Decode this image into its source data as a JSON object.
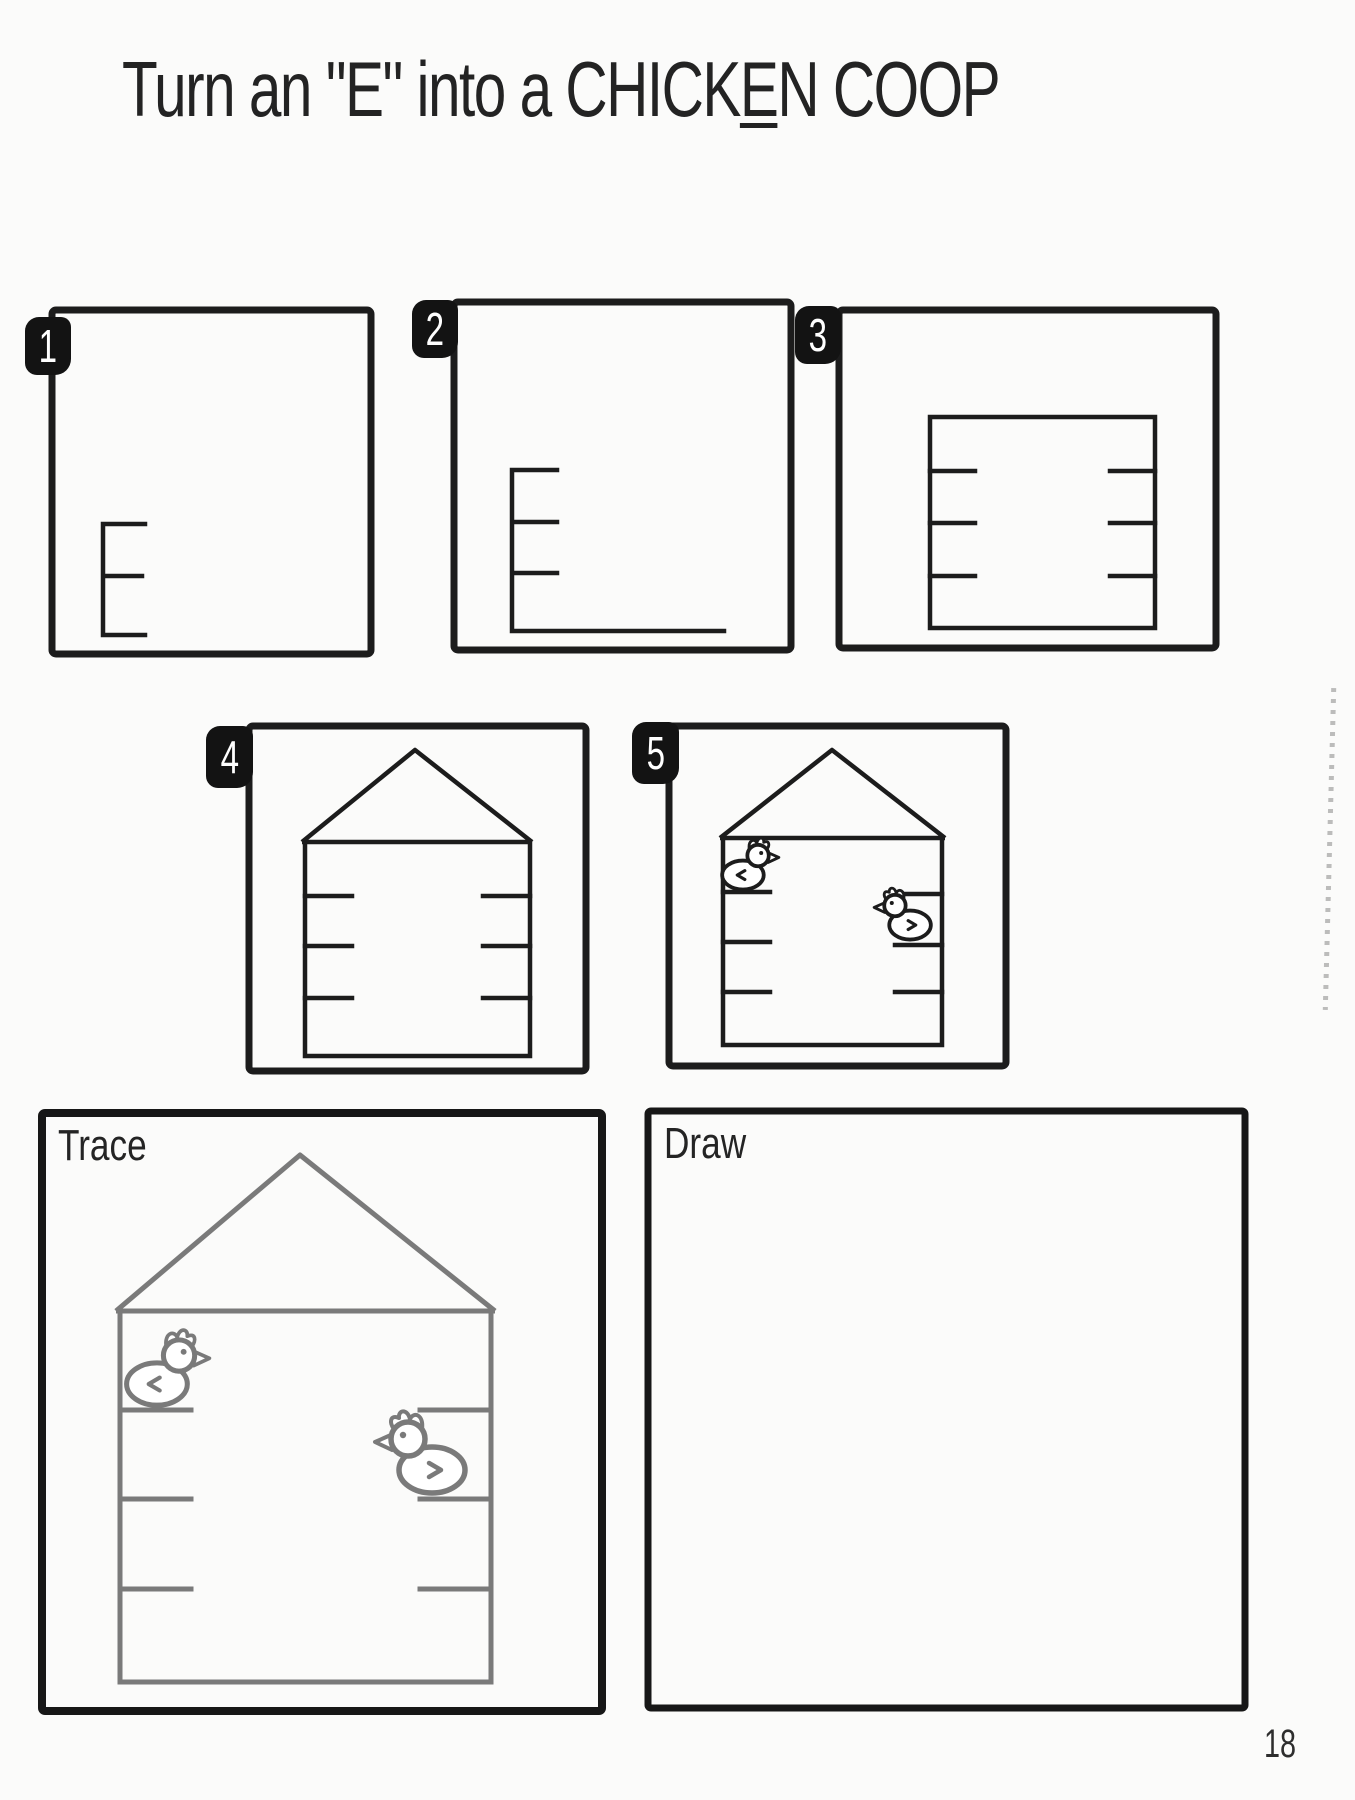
{
  "title": {
    "part1": "Turn an \"E\" into a CHICK",
    "underlined_letter": "E",
    "part3": "N COOP"
  },
  "steps": [
    {
      "number": "1",
      "figure": "letter-E"
    },
    {
      "number": "2",
      "figure": "larger-E-with-long-floor-line"
    },
    {
      "number": "3",
      "figure": "rectangle-coop-with-side-perches"
    },
    {
      "number": "4",
      "figure": "coop-with-roof"
    },
    {
      "number": "5",
      "figure": "coop-with-roof-and-two-chickens"
    }
  ],
  "practice": {
    "trace_label": "Trace",
    "draw_label": "Draw"
  },
  "page": {
    "number": "18"
  },
  "colors": {
    "ink": "#1c1c1c",
    "trace_ink": "#7a7a7a",
    "paper": "#fbfbfa",
    "tab_bg": "#131313",
    "tab_text": "#ffffff"
  }
}
